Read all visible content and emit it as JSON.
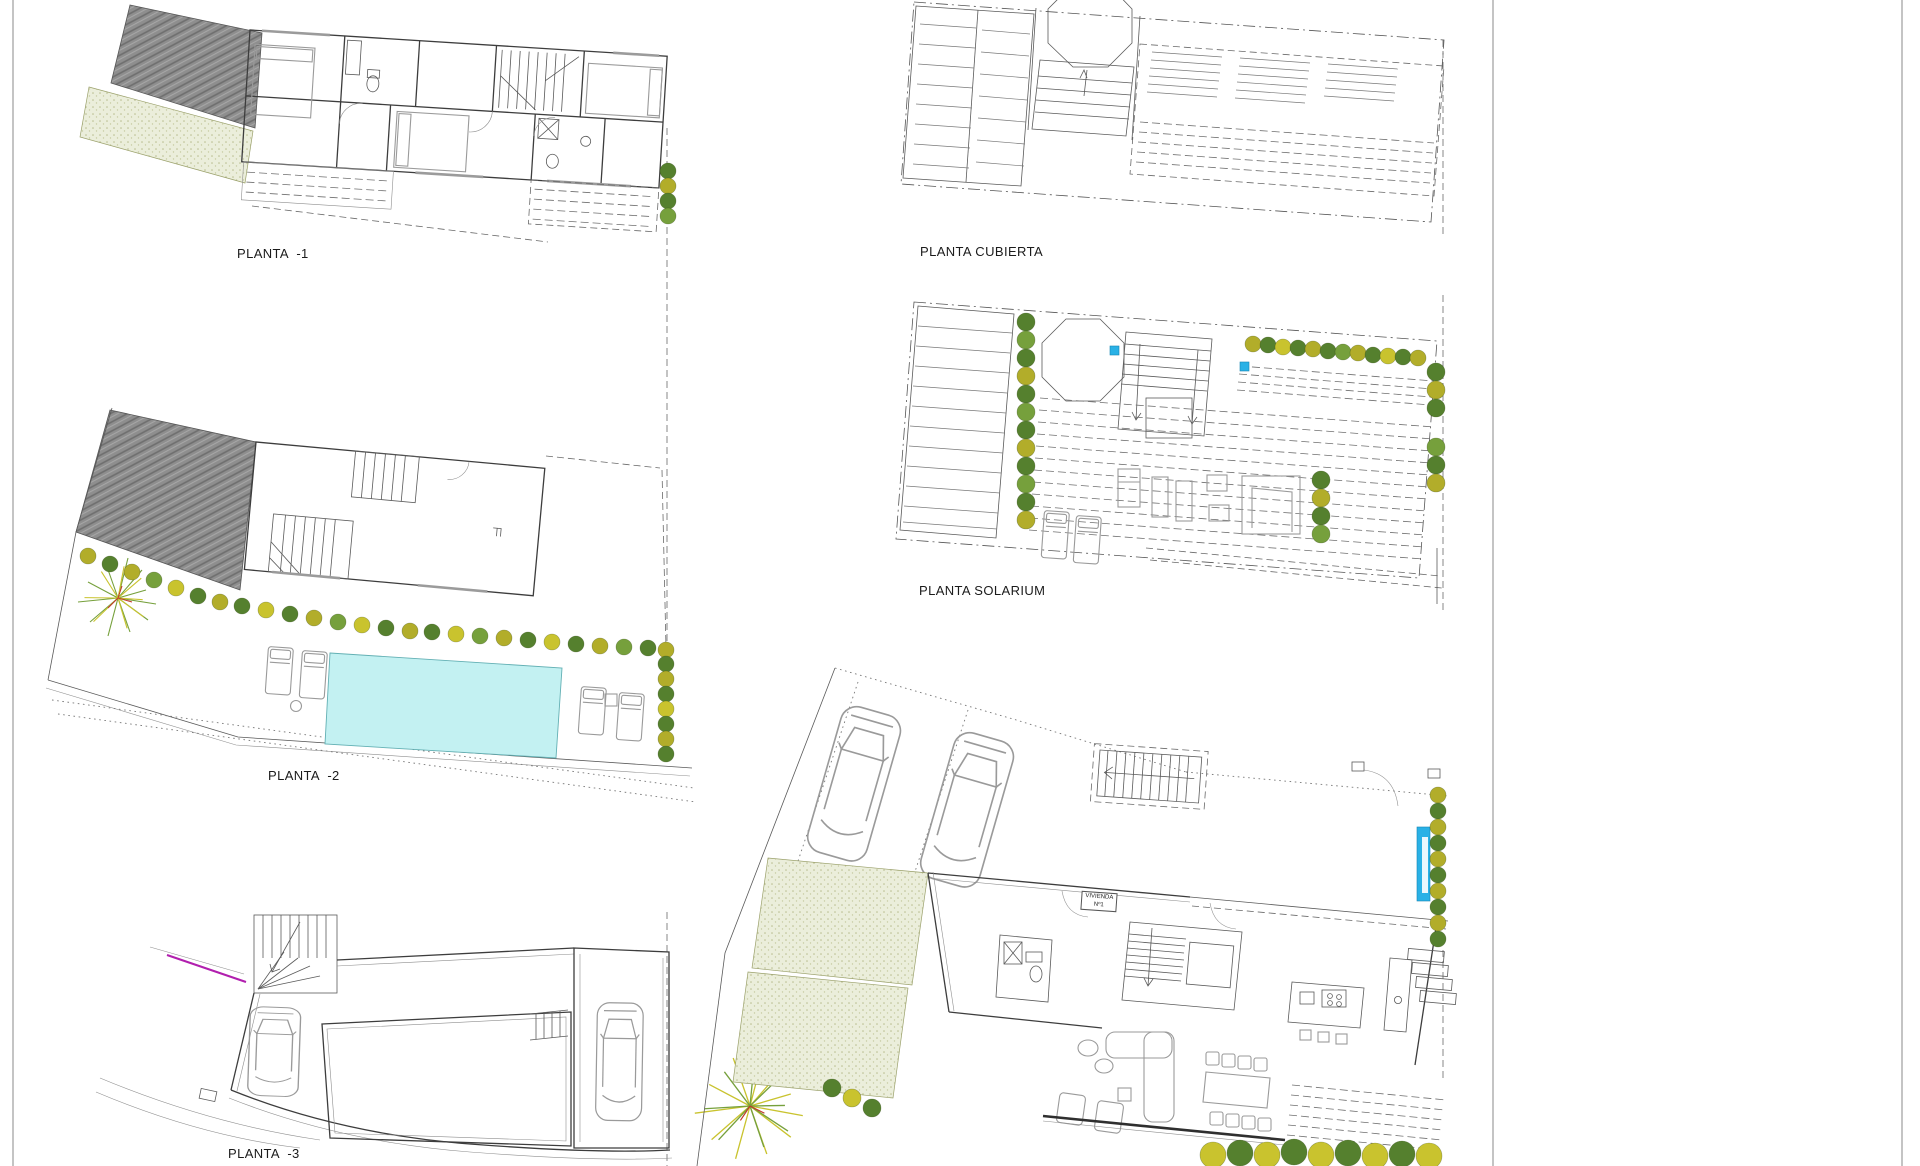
{
  "document": {
    "type": "architectural plan sheet",
    "sheet_background": "#ffffff"
  },
  "labels": {
    "planta_minus_1": "PLANTA  -1",
    "planta_cubierta": "PLANTA CUBIERTA",
    "planta_minus_2": "PLANTA  -2",
    "planta_solarium": "PLANTA SOLARIUM",
    "planta_minus_3": "PLANTA  -3",
    "vivienda_line_1": "VIVIENDA",
    "vivienda_line_2": "Nº1"
  },
  "colors": {
    "roof_hatch": "#8e8e8e",
    "gravel_stipple": "#ebeedb",
    "pool_water": "#c3f1f2",
    "accent_blue": "#29b1e6",
    "magenta_utility_line": "#b11fae",
    "tree_dark_green": "#55802e",
    "tree_mid_green": "#76a03c",
    "tree_olive": "#b2ad2a",
    "tree_yellow": "#c9c32e",
    "line_work": "#5a5a5a",
    "wall": "#3d3d3d",
    "border": "#8a8a8a"
  }
}
